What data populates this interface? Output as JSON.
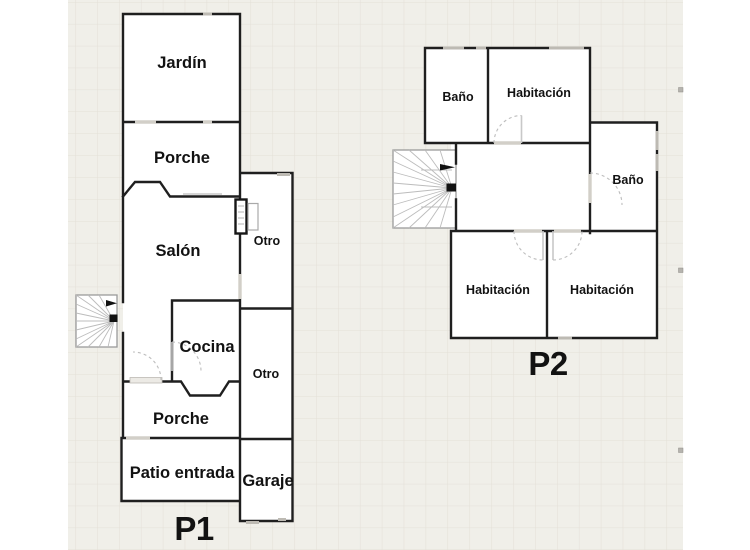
{
  "canvas": {
    "colors": {
      "wall": "#1f1f1f",
      "canvas_bg": "#f0efe9",
      "grid_line": "#e3e0d8"
    }
  },
  "plan1": {
    "label": "P1",
    "rooms": {
      "jardin": "Jardín",
      "porche_top": "Porche",
      "salon": "Salón",
      "otro_top": "Otro",
      "cocina": "Cocina",
      "otro_bottom": "Otro",
      "porche_bottom": "Porche",
      "patio": "Patio entrada",
      "garaje": "Garaje"
    }
  },
  "plan2": {
    "label": "P2",
    "rooms": {
      "bano_top": "Baño",
      "habitacion_top": "Habitación",
      "bano_right": "Baño",
      "habitacion_left": "Habitación",
      "habitacion_right": "Habitación"
    }
  }
}
